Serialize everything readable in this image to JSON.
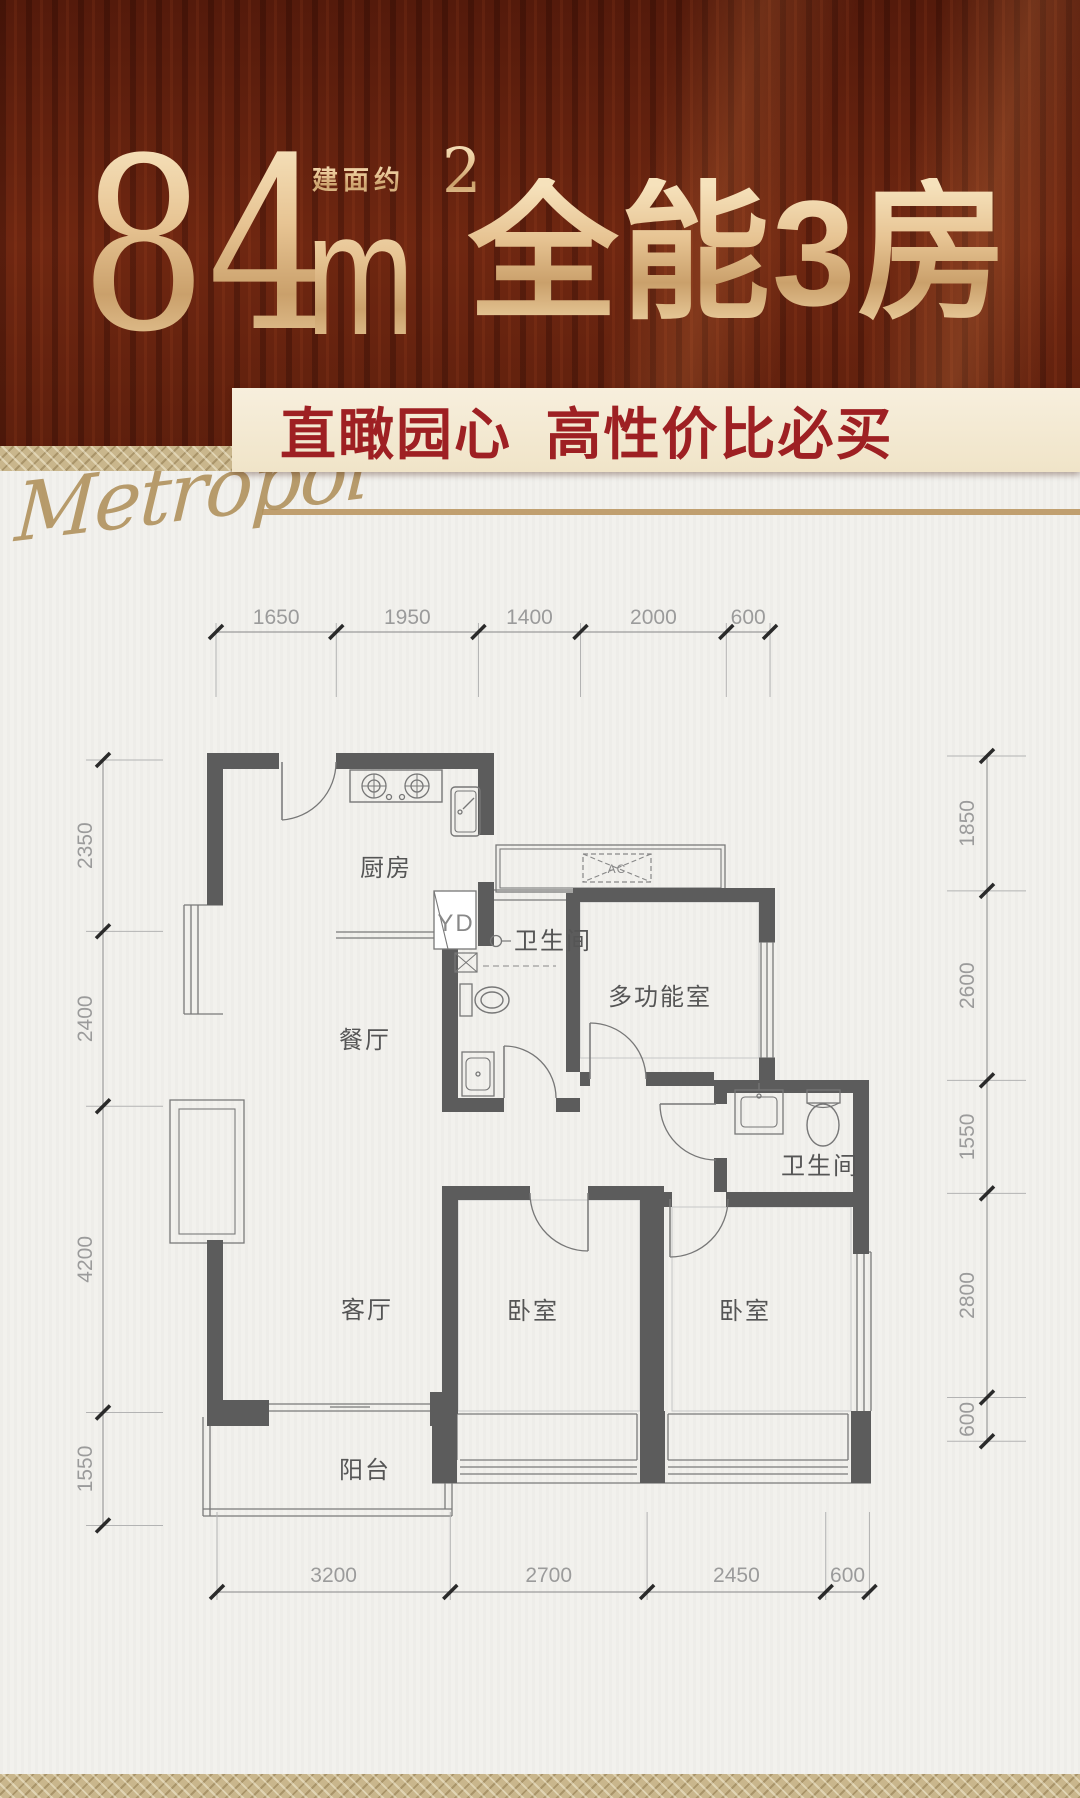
{
  "page": {
    "width": 1080,
    "height": 1798,
    "background": "#f2f1ed"
  },
  "header": {
    "area_value": "84",
    "area_prefix": "建面约",
    "area_unit": "m",
    "area_superscript": "2",
    "headline": "全能3房",
    "banner": {
      "text": "直瞰园心 高性价比必买",
      "bg": "#f4ebd6",
      "color": "#9e2023"
    },
    "watermark": "Metropol",
    "gold_accent": "#e7c493",
    "curtain_red": "#6f2711"
  },
  "floorplan": {
    "wall_color": "#5c5c5c",
    "line_color": "#7a7a7a",
    "dim_color": "#9b9b9b",
    "scale_px_per_mm": 0.0729,
    "rooms": [
      {
        "id": "kitchen",
        "label": "厨房"
      },
      {
        "id": "dining",
        "label": "餐厅"
      },
      {
        "id": "living",
        "label": "客厅"
      },
      {
        "id": "balcony",
        "label": "阳台"
      },
      {
        "id": "bath1",
        "label": "卫生间"
      },
      {
        "id": "bath2",
        "label": "卫生间"
      },
      {
        "id": "multi",
        "label": "多功能室"
      },
      {
        "id": "bed1",
        "label": "卧室"
      },
      {
        "id": "bed2",
        "label": "卧室"
      }
    ],
    "annotations": [
      {
        "id": "yd",
        "label": "YD"
      },
      {
        "id": "ac",
        "label": "AC"
      }
    ],
    "dimensions": {
      "top": {
        "values": [
          "1650",
          "1950",
          "1400",
          "2000",
          "600"
        ]
      },
      "bottom": {
        "values": [
          "3200",
          "2700",
          "2450",
          "600"
        ]
      },
      "left": {
        "values": [
          "2350",
          "2400",
          "4200",
          "1550"
        ]
      },
      "right": {
        "values": [
          "1850",
          "2600",
          "1550",
          "2800",
          "600"
        ]
      }
    }
  }
}
